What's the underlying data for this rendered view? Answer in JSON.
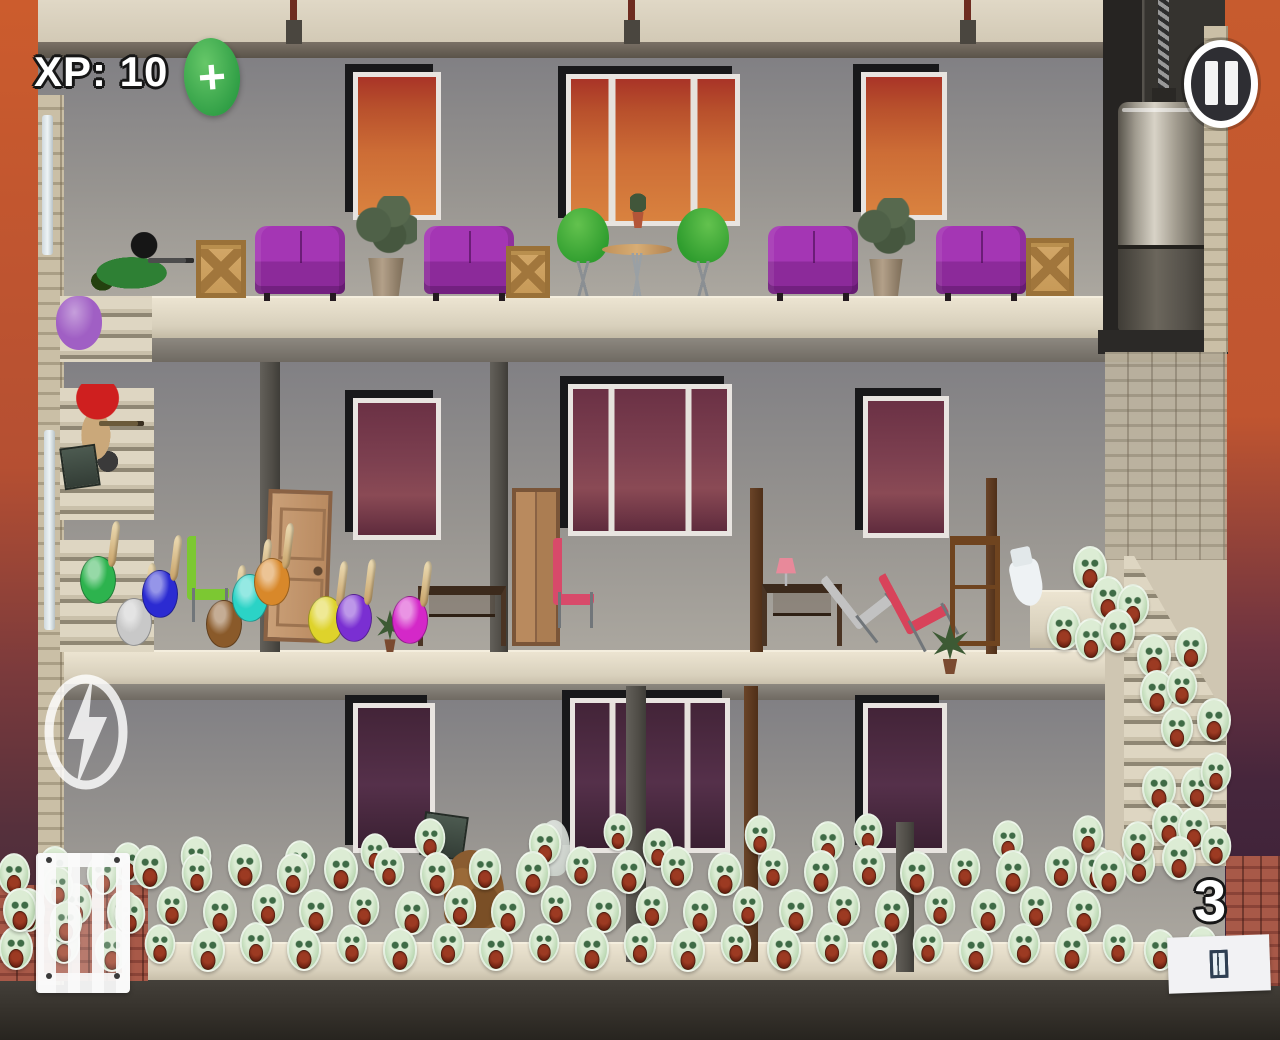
{
  "hud": {
    "xp_label": "XP: 10",
    "plus_label": "+",
    "wave_count": "3",
    "board_count": 3,
    "icons": [
      "plus-icon",
      "pause-icon",
      "lightning-icon",
      "cage-icon",
      "boards-icon"
    ],
    "colors": {
      "xp_text": "#ffffff",
      "xp_outline": "#161616",
      "plus_button_green": "#3fae4c",
      "pause_button_bg": "#2e2e33",
      "pause_button_ring": "#ffffff"
    }
  },
  "scene": {
    "palette": {
      "sky_orange": "#c75b2e",
      "sky_maroon": "#6e3340",
      "sky_purple": "#46263c",
      "wall_gray": "#979490",
      "slab_beige": "#d8d0bc",
      "zombie_green": "#c2dcba",
      "couch_purple": "#9b32a8",
      "window_orange": "#cd6d36",
      "window_maroon": "#7d4050"
    },
    "sprites": [
      {
        "t": "couch",
        "x": 255,
        "y": 226,
        "w": 90,
        "h": 68
      },
      {
        "t": "couch",
        "x": 424,
        "y": 226,
        "w": 90,
        "h": 68
      },
      {
        "t": "couch",
        "x": 768,
        "y": 226,
        "w": 90,
        "h": 68
      },
      {
        "t": "couch",
        "x": 936,
        "y": 226,
        "w": 90,
        "h": 68
      },
      {
        "t": "crate",
        "x": 196,
        "y": 240,
        "w": 50,
        "h": 58
      },
      {
        "t": "crate",
        "x": 506,
        "y": 246,
        "w": 44,
        "h": 52
      },
      {
        "t": "crate",
        "x": 1026,
        "y": 238,
        "w": 48,
        "h": 58
      },
      {
        "t": "planter",
        "x": 352,
        "y": 196,
        "w": 68,
        "h": 100
      },
      {
        "t": "planter",
        "x": 854,
        "y": 198,
        "w": 64,
        "h": 98
      },
      {
        "t": "chair-green",
        "x": 554,
        "y": 208,
        "w": 58,
        "h": 88
      },
      {
        "t": "chair-green flip",
        "x": 674,
        "y": 208,
        "w": 58,
        "h": 88
      },
      {
        "t": "table-round",
        "x": 602,
        "y": 222,
        "w": 70,
        "h": 74
      },
      {
        "t": "plant-pot",
        "x": 628,
        "y": 192,
        "w": 20,
        "h": 36
      },
      {
        "t": "door",
        "x": 266,
        "y": 490,
        "w": 64,
        "h": 152,
        "r": 2
      },
      {
        "t": "wardrobe",
        "x": 512,
        "y": 488,
        "w": 48,
        "h": 158
      },
      {
        "t": "chair",
        "x": 184,
        "y": 536,
        "w": 52,
        "h": 86,
        "c": "#7cc832"
      },
      {
        "t": "chair",
        "x": 550,
        "y": 538,
        "w": 50,
        "h": 90,
        "c": "#d84a6a"
      },
      {
        "t": "desk",
        "x": 418,
        "y": 586,
        "w": 88,
        "h": 60
      },
      {
        "t": "desk",
        "x": 762,
        "y": 584,
        "w": 80,
        "h": 62
      },
      {
        "t": "lamp-pink",
        "x": 776,
        "y": 558,
        "w": 20,
        "h": 28
      },
      {
        "t": "chair",
        "x": 836,
        "y": 556,
        "w": 60,
        "h": 84,
        "c": "#c2c2c2",
        "r": -38
      },
      {
        "t": "chair",
        "x": 892,
        "y": 560,
        "w": 58,
        "h": 88,
        "c": "#d8435a",
        "r": -28
      },
      {
        "t": "shelf",
        "x": 950,
        "y": 536,
        "w": 50,
        "h": 110
      },
      {
        "t": "toilet",
        "x": 1012,
        "y": 560,
        "w": 30,
        "h": 46,
        "r": -12
      },
      {
        "t": "plant-small",
        "x": 932,
        "y": 624,
        "w": 36,
        "h": 50
      },
      {
        "t": "plant-small",
        "x": 376,
        "y": 610,
        "w": 28,
        "h": 42
      },
      {
        "t": "box-dark",
        "x": 422,
        "y": 814,
        "w": 44,
        "h": 44,
        "r": 8
      },
      {
        "t": "rubble",
        "x": 444,
        "y": 850,
        "w": 60,
        "h": 78
      },
      {
        "t": "ghost",
        "x": 538,
        "y": 820,
        "w": 32,
        "h": 56
      },
      {
        "t": "gunner-prone",
        "x": 90,
        "y": 232,
        "w": 104,
        "h": 66
      },
      {
        "t": "gunner-red",
        "x": 58,
        "y": 384,
        "w": 86,
        "h": 88
      },
      {
        "t": "faller",
        "x": 56,
        "y": 296,
        "w": 46,
        "h": 54,
        "c": "#a05fc4"
      },
      {
        "t": "box-dark",
        "x": 62,
        "y": 446,
        "w": 36,
        "h": 42,
        "r": -8
      }
    ],
    "fighters": [
      [
        80,
        556,
        "#2db34e"
      ],
      [
        116,
        598,
        "#c8c8c8"
      ],
      [
        142,
        570,
        "#2b2bd2"
      ],
      [
        206,
        600,
        "#8a5a2a"
      ],
      [
        232,
        574,
        "#2bd3c6"
      ],
      [
        254,
        558,
        "#d8882a"
      ],
      [
        308,
        596,
        "#ded32b"
      ],
      [
        336,
        594,
        "#7a2fd2"
      ],
      [
        392,
        596,
        "#d428c8"
      ]
    ],
    "zombies": [
      [
        1090,
        546,
        1
      ],
      [
        1108,
        576,
        1
      ],
      [
        1133,
        583,
        0.95
      ],
      [
        1064,
        606,
        1
      ],
      [
        1091,
        617,
        0.95
      ],
      [
        1118,
        609,
        1
      ],
      [
        1154,
        634,
        1
      ],
      [
        1191,
        626,
        0.95
      ],
      [
        1157,
        670,
        1
      ],
      [
        1182,
        664,
        0.9
      ],
      [
        1214,
        698,
        1
      ],
      [
        1177,
        706,
        0.95
      ],
      [
        1159,
        766,
        1
      ],
      [
        1197,
        766,
        0.95
      ],
      [
        1216,
        750,
        0.9
      ],
      [
        1169,
        802,
        1
      ],
      [
        1194,
        806,
        0.95
      ],
      [
        1216,
        824,
        0.9
      ],
      [
        1179,
        836,
        1
      ],
      [
        1139,
        841,
        0.95
      ],
      [
        1097,
        846,
        1
      ],
      [
        430,
        816,
        0.9
      ],
      [
        545,
        822,
        0.95
      ],
      [
        618,
        810,
        0.85
      ],
      [
        658,
        826,
        0.9
      ],
      [
        760,
        813,
        0.9
      ],
      [
        828,
        820,
        0.95
      ],
      [
        868,
        810,
        0.85
      ],
      [
        1008,
        818,
        0.9
      ],
      [
        1088,
        813,
        0.9
      ],
      [
        1138,
        820,
        0.95
      ],
      [
        128,
        840,
        0.9
      ],
      [
        196,
        834,
        0.9
      ],
      [
        300,
        838,
        0.9
      ],
      [
        375,
        830,
        0.85
      ],
      [
        55,
        846,
        1
      ],
      [
        103,
        852,
        0.95
      ],
      [
        150,
        845,
        1
      ],
      [
        197,
        851,
        0.9
      ],
      [
        245,
        844,
        1
      ],
      [
        293,
        852,
        0.95
      ],
      [
        341,
        847,
        1
      ],
      [
        389,
        845,
        0.9
      ],
      [
        437,
        852,
        1
      ],
      [
        485,
        847,
        0.95
      ],
      [
        533,
        851,
        1
      ],
      [
        581,
        844,
        0.9
      ],
      [
        629,
        850,
        1
      ],
      [
        677,
        845,
        0.95
      ],
      [
        725,
        852,
        1
      ],
      [
        773,
        846,
        0.9
      ],
      [
        821,
        850,
        1
      ],
      [
        869,
        844,
        0.95
      ],
      [
        917,
        851,
        1
      ],
      [
        965,
        846,
        0.9
      ],
      [
        1013,
        850,
        1
      ],
      [
        1061,
        845,
        0.95
      ],
      [
        1109,
        850,
        1
      ],
      [
        28,
        888,
        1
      ],
      [
        76,
        882,
        0.95
      ],
      [
        124,
        890,
        1
      ],
      [
        172,
        884,
        0.9
      ],
      [
        220,
        890,
        1
      ],
      [
        268,
        883,
        0.95
      ],
      [
        316,
        889,
        1
      ],
      [
        364,
        885,
        0.9
      ],
      [
        412,
        891,
        1
      ],
      [
        460,
        884,
        0.95
      ],
      [
        508,
        890,
        1
      ],
      [
        556,
        883,
        0.9
      ],
      [
        604,
        889,
        1
      ],
      [
        652,
        885,
        0.95
      ],
      [
        700,
        890,
        1
      ],
      [
        748,
        884,
        0.9
      ],
      [
        796,
        889,
        1
      ],
      [
        844,
        885,
        0.95
      ],
      [
        892,
        890,
        1
      ],
      [
        940,
        884,
        0.9
      ],
      [
        988,
        889,
        1
      ],
      [
        1036,
        885,
        0.95
      ],
      [
        1084,
        890,
        1
      ],
      [
        16,
        926,
        1
      ],
      [
        64,
        921,
        0.95
      ],
      [
        112,
        928,
        1
      ],
      [
        160,
        922,
        0.9
      ],
      [
        208,
        928,
        1
      ],
      [
        256,
        921,
        0.95
      ],
      [
        304,
        927,
        1
      ],
      [
        352,
        922,
        0.9
      ],
      [
        400,
        928,
        1
      ],
      [
        448,
        922,
        0.95
      ],
      [
        496,
        927,
        1
      ],
      [
        544,
        921,
        0.9
      ],
      [
        592,
        927,
        1
      ],
      [
        640,
        922,
        0.95
      ],
      [
        688,
        928,
        1
      ],
      [
        736,
        922,
        0.9
      ],
      [
        784,
        927,
        1
      ],
      [
        832,
        921,
        0.95
      ],
      [
        880,
        927,
        1
      ],
      [
        928,
        922,
        0.9
      ],
      [
        976,
        928,
        1
      ],
      [
        1024,
        922,
        0.95
      ],
      [
        1072,
        927,
        1
      ],
      [
        1118,
        922,
        0.9
      ],
      [
        1160,
        928,
        0.95
      ],
      [
        1202,
        924,
        0.9
      ],
      [
        14,
        852,
        0.95
      ],
      [
        58,
        864,
        0.9
      ],
      [
        20,
        888,
        1
      ],
      [
        66,
        900,
        0.95
      ],
      [
        130,
        892,
        0.9
      ]
    ]
  }
}
